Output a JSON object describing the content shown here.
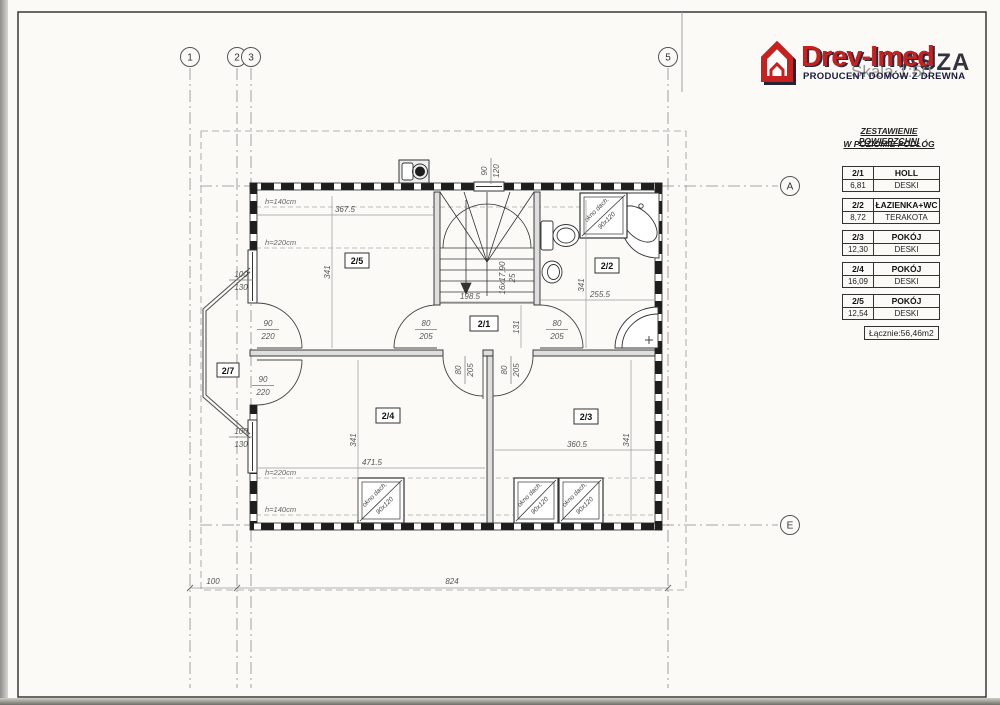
{
  "header": {
    "brand": "Drev-Imed",
    "tagline": "PRODUCENT DOMÓW Z DREWNA",
    "partial_title": "ASZA",
    "scale": "Skala 1:50"
  },
  "area_table": {
    "title_line1": "ZESTAWIENIE POWIERZCHNI",
    "title_line2": "W POZIOMIE PODŁÓG",
    "rooms": [
      {
        "id": "2/1",
        "name": "HOLL",
        "area": "6,81",
        "floor": "DESKI"
      },
      {
        "id": "2/2",
        "name": "ŁAZIENKA+WC",
        "area": "8,72",
        "floor": "TERAKOTA"
      },
      {
        "id": "2/3",
        "name": "POKÓJ",
        "area": "12,30",
        "floor": "DESKI"
      },
      {
        "id": "2/4",
        "name": "POKÓJ",
        "area": "16,09",
        "floor": "DESKI"
      },
      {
        "id": "2/5",
        "name": "POKÓJ",
        "area": "12,54",
        "floor": "DESKI"
      }
    ],
    "total": "Łącznie:56,46m2"
  },
  "grid": {
    "columns": [
      "1",
      "2",
      "3",
      "5"
    ],
    "rows": [
      "A",
      "E"
    ]
  },
  "room_labels": {
    "r21": "2/1",
    "r22": "2/2",
    "r23": "2/3",
    "r24": "2/4",
    "r25": "2/5",
    "r27": "2/7"
  },
  "dims": {
    "room25_w": "367.5",
    "room25_hdim": "341",
    "room24_w": "471.5",
    "room24_hdim": "341",
    "room23_w": "360.5",
    "room23_hdim": "341",
    "bath_w": "255.5",
    "bath_hdim": "341",
    "hall_w": "198.5",
    "hall_d": "131",
    "stair_note1": "16x17,90",
    "stair_note2": "25",
    "h140": "h=140cm",
    "h220": "h=220cm",
    "overall_left": "100",
    "overall_main": "824",
    "door90_w": "90",
    "door90_h": "220",
    "door80_w": "80",
    "door80_h": "205",
    "win100_w": "100",
    "win100_h": "130",
    "roofwin_w": "90",
    "roofwin_h": "120"
  },
  "skylight": {
    "label": "okno dach.",
    "size": "90x120"
  }
}
